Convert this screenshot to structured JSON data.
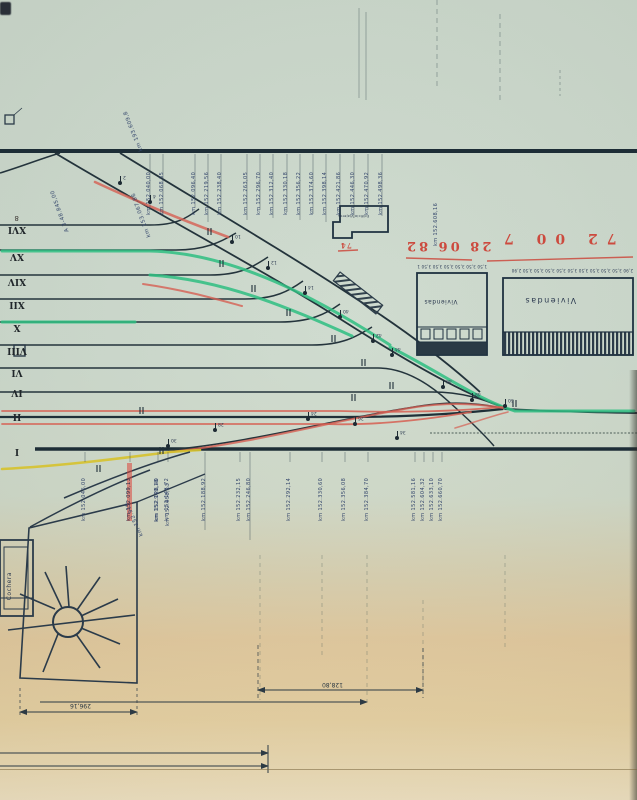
{
  "drawing": {
    "type": "railway-station-track-plan (inverted scan)",
    "ink": "#2a3a42",
    "accent_green": "#2fbf82",
    "accent_red": "#d65f52",
    "accent_yellow": "#d6c22c",
    "label_ink": "#33456b"
  },
  "roman_tracks": [
    {
      "label": "XVI",
      "y": 229
    },
    {
      "label": "XV",
      "y": 256
    },
    {
      "label": "XIV",
      "y": 281
    },
    {
      "label": "XII",
      "y": 304
    },
    {
      "label": "X",
      "y": 327
    },
    {
      "label": "VIII",
      "y": 350
    },
    {
      "label": "VI",
      "y": 372
    },
    {
      "label": "IV",
      "y": 392
    },
    {
      "label": "II",
      "y": 416
    },
    {
      "label": "I",
      "y": 451
    }
  ],
  "km_labels_top": [
    {
      "x": 150,
      "text": "km 152.040,00"
    },
    {
      "x": 163,
      "text": "km 152.068,35"
    },
    {
      "x": 195,
      "text": "km 152.096,40"
    },
    {
      "x": 208,
      "text": "km 152.219,56"
    },
    {
      "x": 221,
      "text": "km 152.238,40"
    },
    {
      "x": 247,
      "text": "km 152.263,05"
    },
    {
      "x": 260,
      "text": "km 152.296,70"
    },
    {
      "x": 273,
      "text": "km 152.312,40"
    },
    {
      "x": 287,
      "text": "km 152.330,18"
    },
    {
      "x": 300,
      "text": "km 152.356,22"
    },
    {
      "x": 313,
      "text": "km 152.374,60"
    },
    {
      "x": 326,
      "text": "km 152.398,14"
    },
    {
      "x": 340,
      "text": "km 152.421,86"
    },
    {
      "x": 354,
      "text": "km 152.446,30"
    },
    {
      "x": 368,
      "text": "km 152.470,92"
    },
    {
      "x": 382,
      "text": "km 152.498,36"
    }
  ],
  "km_labels_bottom": [
    {
      "x": 85,
      "text": "km 152.046,00",
      "hl": false
    },
    {
      "x": 130,
      "text": "km 152.099,13",
      "hl": true
    },
    {
      "x": 158,
      "text": "km 152.128,40",
      "hl": false
    },
    {
      "x": 168,
      "text": "km 152.146,72",
      "hl": false
    },
    {
      "x": 205,
      "text": "km 152.188,92",
      "hl": false
    },
    {
      "x": 240,
      "text": "km 152.232,15",
      "hl": false
    },
    {
      "x": 250,
      "text": "km 152.246,80",
      "hl": false
    },
    {
      "x": 290,
      "text": "km 152.292,14",
      "hl": false
    },
    {
      "x": 322,
      "text": "km 152.330,60",
      "hl": false
    },
    {
      "x": 345,
      "text": "km 152.356,08",
      "hl": false
    },
    {
      "x": 368,
      "text": "km 152.384,70",
      "hl": false
    },
    {
      "x": 415,
      "text": "km 152.581,16",
      "hl": false
    },
    {
      "x": 424,
      "text": "km 152.604,32",
      "hl": false
    },
    {
      "x": 433,
      "text": "km 152.633,10",
      "hl": false
    },
    {
      "x": 442,
      "text": "km 152.660,70",
      "hl": false
    }
  ],
  "km_labels_misc": [
    {
      "x": 437,
      "y": 196,
      "text": "km 152.608,16",
      "kind": "vertical"
    },
    {
      "x": 158,
      "y": 472,
      "text": "km 152.940,18",
      "kind": "vertical"
    },
    {
      "x": 169,
      "y": 476,
      "text": "km 152.958,13",
      "kind": "vertical"
    }
  ],
  "diagonal_labels": [
    {
      "x": 112,
      "y": 128,
      "rot": 248,
      "text": "km 193.609,8"
    },
    {
      "x": 38,
      "y": 208,
      "rot": 250,
      "text": "A 3-48.845,00"
    },
    {
      "x": 118,
      "y": 212,
      "rot": 250,
      "text": "km 153.067,86"
    },
    {
      "x": 116,
      "y": 516,
      "rot": 246,
      "text": "km 152.913"
    }
  ],
  "red_annotations": {
    "note_left": "28 06 82",
    "note_right": "72 00 7",
    "small_note": "74"
  },
  "dimensions": {
    "dim_mid": "128,80",
    "dim_turntable": "296,16"
  },
  "buildings": {
    "viviendas_label": "Viviendas",
    "mid_label": "Viviendas",
    "cochera_label": "Cochera",
    "station_label": "Edificio Viajeros",
    "chain_mid": "1,50 3,50 3,50 3,50 3,50 3,50 1,50",
    "chain_viviendas": "2,90 3,50 3,50 3,50 3,50 3,50 3,50 3,50 3,50 3,50 2,90"
  },
  "switches": [
    {
      "x": 120,
      "y": 183,
      "n": "2"
    },
    {
      "x": 150,
      "y": 202,
      "n": "4"
    },
    {
      "x": 232,
      "y": 242,
      "n": "10"
    },
    {
      "x": 268,
      "y": 268,
      "n": "12"
    },
    {
      "x": 305,
      "y": 293,
      "n": "14"
    },
    {
      "x": 340,
      "y": 317,
      "n": "40"
    },
    {
      "x": 373,
      "y": 341,
      "n": "42"
    },
    {
      "x": 392,
      "y": 355,
      "n": "44"
    },
    {
      "x": 443,
      "y": 387,
      "n": "46"
    },
    {
      "x": 472,
      "y": 400,
      "n": "48"
    },
    {
      "x": 505,
      "y": 406,
      "n": "50"
    },
    {
      "x": 308,
      "y": 419,
      "n": "24"
    },
    {
      "x": 355,
      "y": 424,
      "n": "26"
    },
    {
      "x": 215,
      "y": 430,
      "n": "28"
    },
    {
      "x": 168,
      "y": 446,
      "n": "30"
    },
    {
      "x": 397,
      "y": 438,
      "n": "34"
    }
  ],
  "stray_marks": {
    "eight": "8"
  }
}
